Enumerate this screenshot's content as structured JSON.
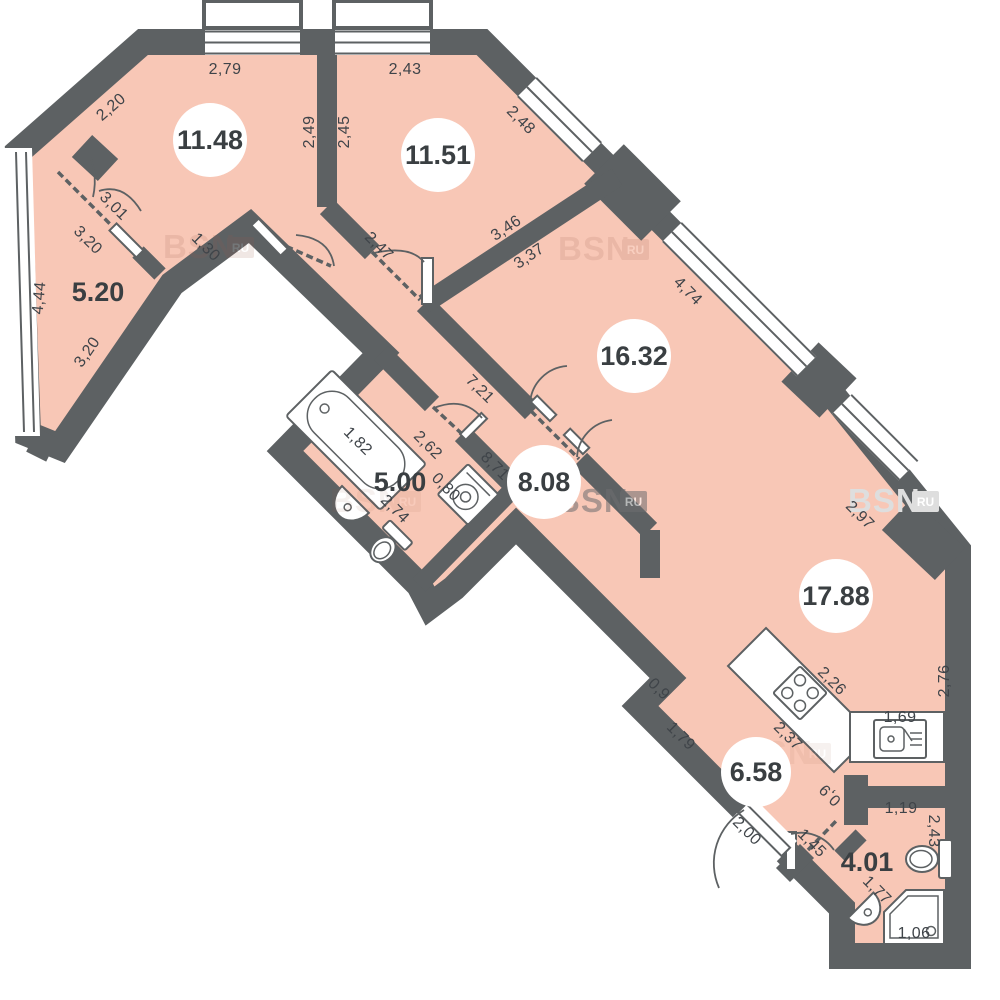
{
  "plan_title": "apartment-floor-plan",
  "colors": {
    "wall": "#5d6163",
    "floor": "#f8c7b6",
    "label_text": "#3f4449",
    "background": "#ffffff",
    "watermark_dark": "#6e6e70",
    "watermark_light": "#dedede"
  },
  "watermark": {
    "text": "BSN",
    "badge": "RU"
  },
  "rooms": [
    {
      "area": "11.48"
    },
    {
      "area": "11.51"
    },
    {
      "area": "5.20"
    },
    {
      "area": "16.32"
    },
    {
      "area": "5.00"
    },
    {
      "area": "8.08"
    },
    {
      "area": "17.88"
    },
    {
      "area": "6.58"
    },
    {
      "area": "4.01"
    }
  ],
  "dims": [
    {
      "v": "2,79"
    },
    {
      "v": "2,43"
    },
    {
      "v": "2,20"
    },
    {
      "v": "2,49"
    },
    {
      "v": "2,45"
    },
    {
      "v": "2,48"
    },
    {
      "v": "3,01"
    },
    {
      "v": "3,20"
    },
    {
      "v": "1,30"
    },
    {
      "v": "4,44"
    },
    {
      "v": "3,20"
    },
    {
      "v": "2,47"
    },
    {
      "v": "3,46"
    },
    {
      "v": "3,37"
    },
    {
      "v": "4,74"
    },
    {
      "v": "7,21"
    },
    {
      "v": "1,82"
    },
    {
      "v": "2,62"
    },
    {
      "v": "8,71"
    },
    {
      "v": "0,80"
    },
    {
      "v": "2,74"
    },
    {
      "v": "2,97"
    },
    {
      "v": "2,76"
    },
    {
      "v": "2,26"
    },
    {
      "v": "1,69"
    },
    {
      "v": "2,37"
    },
    {
      "v": "0,9"
    },
    {
      "v": "1,79"
    },
    {
      "v": "2,00"
    },
    {
      "v": "1,45"
    },
    {
      "v": "0,9"
    },
    {
      "v": "1,19"
    },
    {
      "v": "2,43"
    },
    {
      "v": "1,77"
    },
    {
      "v": "1,06"
    }
  ]
}
